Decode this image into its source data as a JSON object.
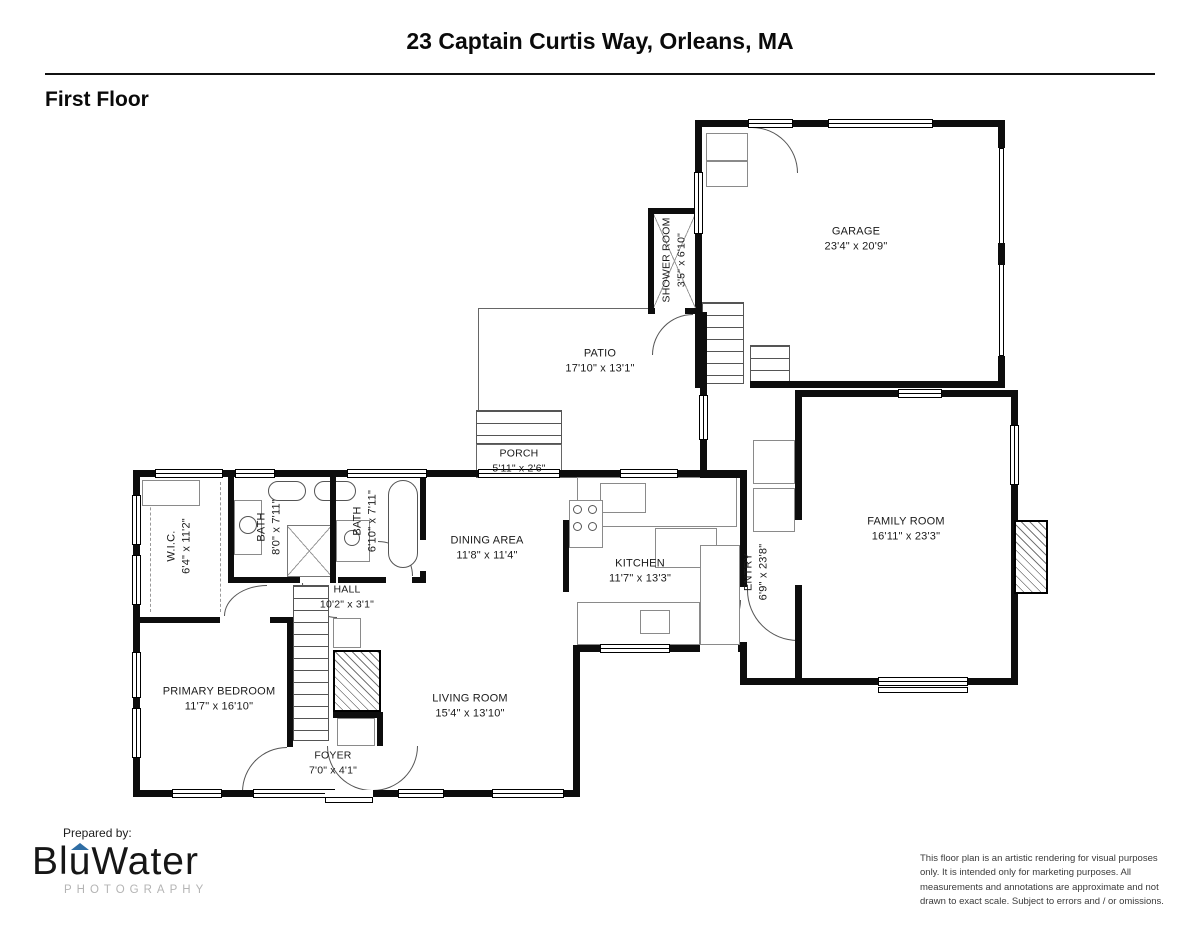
{
  "page": {
    "title": "23 Captain Curtis Way, Orleans, MA",
    "floor_label": "First Floor",
    "prepared_by": "Prepared by:",
    "disclaimer": "This floor plan is an artistic rendering for visual purposes only. It is intended only for marketing purposes. All measurements and annotations are approximate and not drawn to exact scale. Subject to errors and / or omissions."
  },
  "logo": {
    "part1": "Bl",
    "part2": "u",
    "part3": "Water",
    "subtitle": "PHOTOGRAPHY",
    "accent_color": "#2e6da4"
  },
  "rooms": {
    "garage": {
      "name": "GARAGE",
      "dims": "23'4\" x 20'9\""
    },
    "shower_room": {
      "name": "SHOWER ROOM",
      "dims": "3'5\" x 6'10\""
    },
    "patio": {
      "name": "PATIO",
      "dims": "17'10\" x 13'1\""
    },
    "porch": {
      "name": "PORCH",
      "dims": "5'11\" x 2'6\""
    },
    "family_room": {
      "name": "FAMILY ROOM",
      "dims": "16'11\" x 23'3\""
    },
    "entry": {
      "name": "ENTRY",
      "dims": "6'9\" x 23'8\""
    },
    "kitchen": {
      "name": "KITCHEN",
      "dims": "11'7\" x 13'3\""
    },
    "dining_area": {
      "name": "DINING AREA",
      "dims": "11'8\" x 11'4\""
    },
    "wic": {
      "name": "W.I.C.",
      "dims": "6'4\" x 11'2\""
    },
    "bath1": {
      "name": "BATH",
      "dims": "8'0\" x 7'11\""
    },
    "bath2": {
      "name": "BATH",
      "dims": "6'10\" x 7'11\""
    },
    "hall": {
      "name": "HALL",
      "dims": "10'2\" x 3'1\""
    },
    "primary_bedroom": {
      "name": "PRIMARY BEDROOM",
      "dims": "11'7\" x 16'10\""
    },
    "living_room": {
      "name": "LIVING ROOM",
      "dims": "15'4\" x 13'10\""
    },
    "foyer": {
      "name": "FOYER",
      "dims": "7'0\" x 4'1\""
    }
  }
}
